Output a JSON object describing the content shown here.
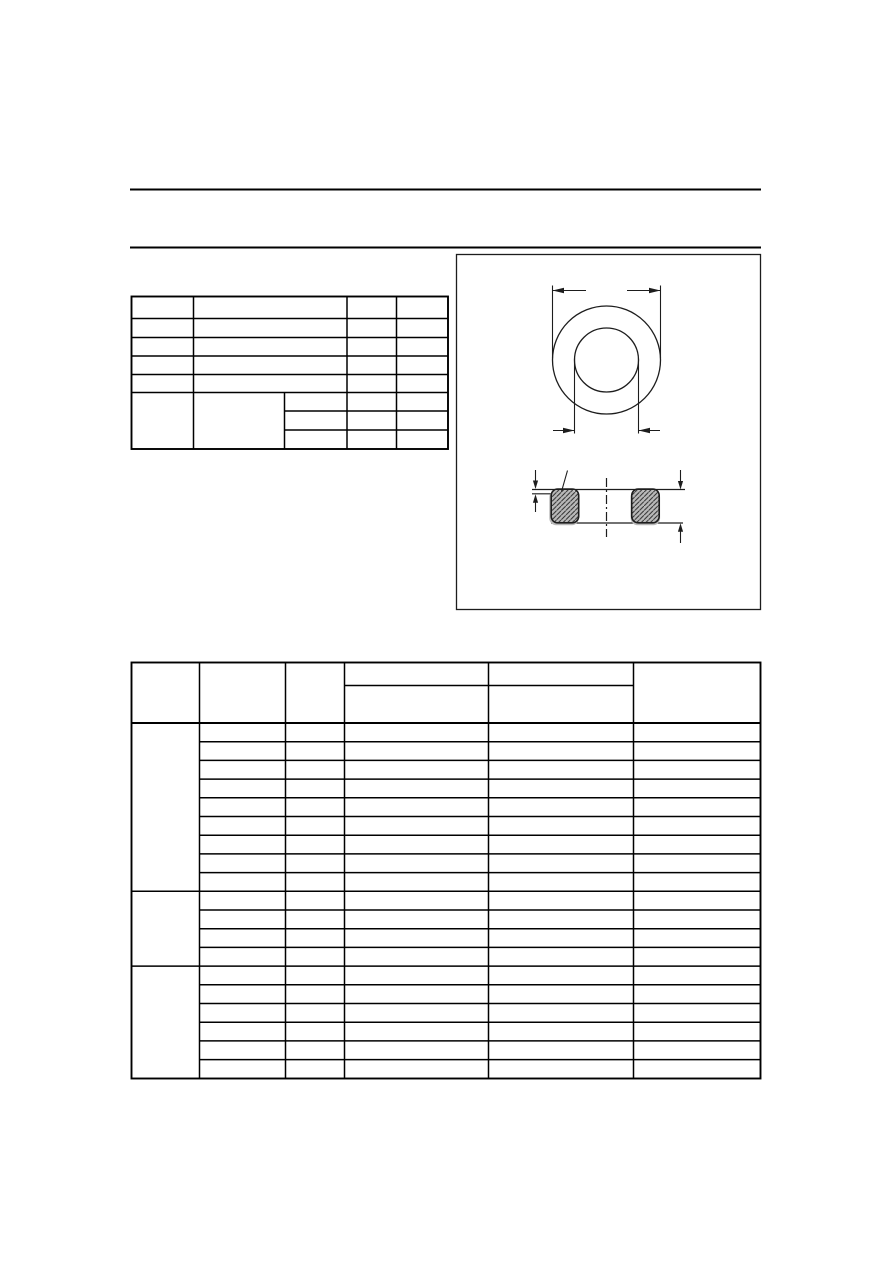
{
  "page": {
    "type": "datasheet-page",
    "background_color": "#ffffff",
    "rule_color": "#000000",
    "text_rendered": false
  },
  "header_rules": {
    "count": 2
  },
  "quick_reference_table": {
    "column_count": 4,
    "simple_row_count": 5,
    "grouped_section": {
      "row_count": 3,
      "has_extra_split_column": true
    },
    "all_cells_empty": true
  },
  "dimension_drawing": {
    "frame": "rectangular-border",
    "views": [
      "toroid-top-view",
      "toroid-cross-section"
    ],
    "top_view": {
      "shapes": [
        "outer-circle",
        "inner-circle"
      ],
      "dimensions": [
        "outer-diameter",
        "inner-diameter"
      ]
    },
    "cross_section": {
      "shapes": [
        "left-core-section",
        "right-core-section"
      ],
      "hatched": true,
      "coating_color": "#b9b9b9",
      "centerline_style": "dash-dot",
      "dimensions": [
        "coating-thickness",
        "core-height"
      ]
    },
    "line_color": "#1d1d1d"
  },
  "specification_table": {
    "column_count": 6,
    "header": {
      "rows": 2,
      "split_header_columns": [
        4,
        5
      ]
    },
    "row_groups": [
      9,
      4,
      6
    ],
    "total_data_rows": 19,
    "all_cells_empty": true
  }
}
